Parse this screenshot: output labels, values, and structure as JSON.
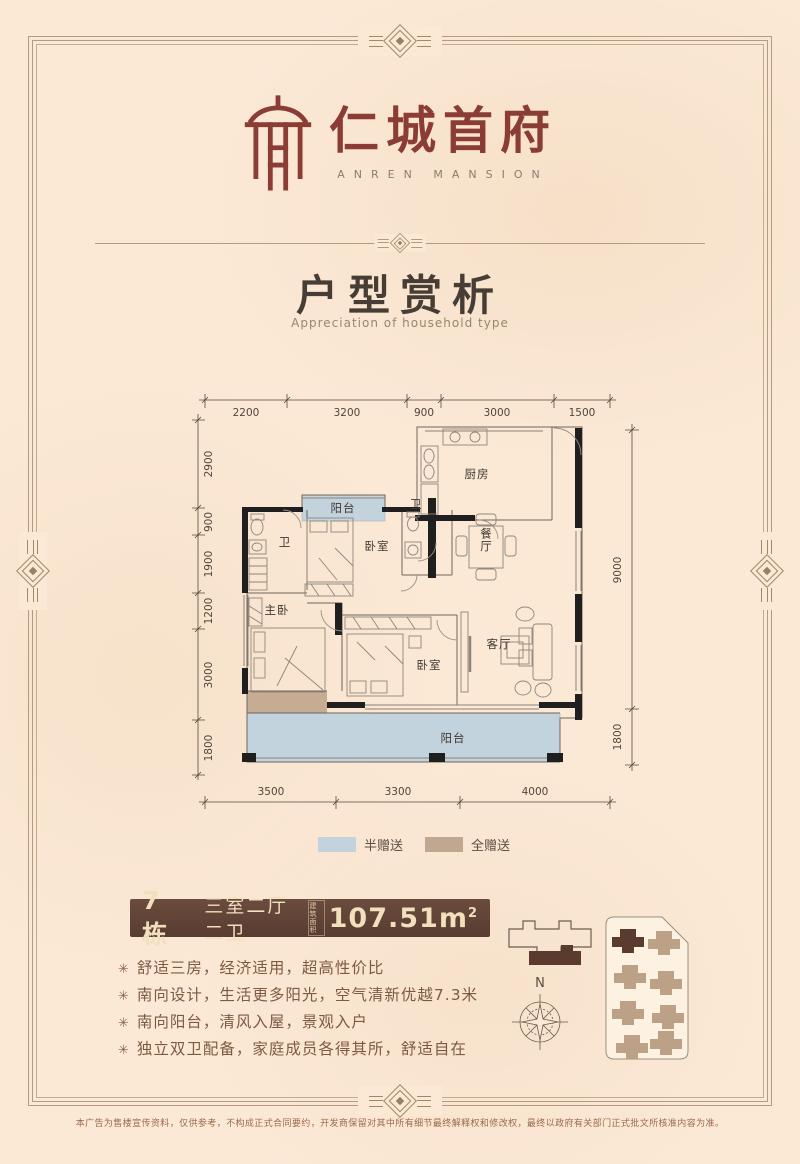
{
  "brand": {
    "name": "仁城首府",
    "name_en": "ANREN MANSION"
  },
  "section": {
    "title": "户型赏析",
    "subtitle": "Appreciation of household type"
  },
  "plan": {
    "dims": {
      "top": [
        "2200",
        "3200",
        "900",
        "3000",
        "1500"
      ],
      "left": [
        "2900",
        "900",
        "1900",
        "1200",
        "3000",
        "1800"
      ],
      "right": [
        "9000",
        "1800"
      ],
      "bottom": [
        "3500",
        "3300",
        "4000"
      ]
    },
    "rooms": {
      "kitchen": "厨房",
      "dining": "餐厅",
      "bath1": "卫",
      "bath2": "卫",
      "bedroom1": "卧室",
      "bedroom2": "卧室",
      "master": "主卧",
      "living": "客厅",
      "balcony_top": "阳台",
      "balcony_bottom": "阳台"
    },
    "colors": {
      "half_gift": "#c2d3de",
      "full_gift": "#c6ac93",
      "wall": "#1f1f1f"
    }
  },
  "legend": {
    "half_label": "半赠送",
    "full_label": "全赠送"
  },
  "unit": {
    "building": "7栋",
    "layout": "三室二厅二卫",
    "area_label": "建筑面积",
    "area_value": "107.51m",
    "area_sup": "2"
  },
  "features": {
    "bullet": "✳",
    "items": [
      "舒适三房，经济适用，超高性价比",
      "南向设计，生活更多阳光，空气清新优越7.3米",
      "南向阳台，清风入屋，景观入户",
      "独立双卫配备，家庭成员各得其所，舒适自在"
    ]
  },
  "compass": {
    "north_label": "N"
  },
  "footer": {
    "disclaimer": "本广告为售楼宣传资料，仅供参考，不构成正式合同要约，开发商保留对其中所有细节最终解释权和修改权，最终以政府有关部门正式批文所核准内容为准。"
  },
  "theme": {
    "bg": "#fbe9d6",
    "maroon": "#8a3c35",
    "bar_bg": "#5f4236",
    "text_brown": "#7e5a43"
  }
}
